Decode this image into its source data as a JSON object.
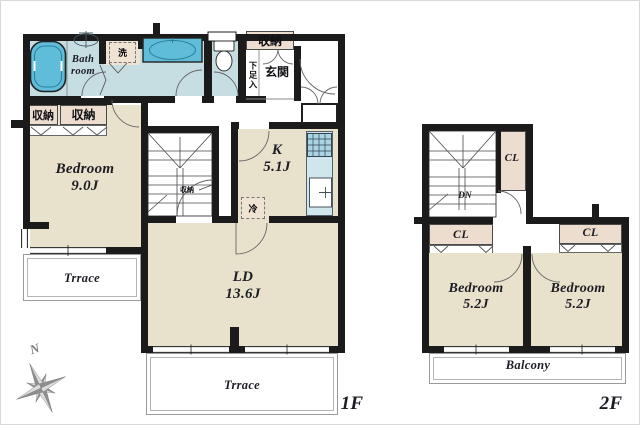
{
  "palette": {
    "wall": "#1b1b1b",
    "floor_beige": "#e8e1cb",
    "closet_beige": "#ecddce",
    "wet_blue": "#c6dde1",
    "fixture_blue": "#5fbdd9",
    "counter_blue": "#cfe7ec",
    "terrace_line": "#9a9a9a",
    "compass_gray": "#8e8e8e"
  },
  "icons": [
    "bathtub-icon",
    "washbasin-icon",
    "vanity-icon",
    "toilet-icon",
    "stove-icon",
    "kitchen-sink-icon",
    "refrigerator-space",
    "laundry-space",
    "staircase",
    "door-arc",
    "compass-rose-icon"
  ],
  "floor1": {
    "label": "1F",
    "bathroom_label": "Bath room",
    "laundry_label": "洗",
    "closet_left": "収納",
    "closet_right": "収納",
    "entry_storage": "収納",
    "shoe_cabinet": "下足入",
    "entrance": "玄関",
    "stair_storage": "収納",
    "bedroom": {
      "name": "Bedroom",
      "area": "9.0J"
    },
    "kitchen": {
      "name": "K",
      "area": "5.1J"
    },
    "fridge": "冷",
    "living": {
      "name": "LD",
      "area": "13.6J"
    },
    "terrace_side": "Trrace",
    "terrace_main": "Trrace"
  },
  "floor2": {
    "label": "2F",
    "closet_upper": "CL",
    "closet_left": "CL",
    "closet_right": "CL",
    "stairs_down": "DN",
    "bedroom_left": {
      "name": "Bedroom",
      "area": "5.2J"
    },
    "bedroom_right": {
      "name": "Bedroom",
      "area": "5.2J"
    },
    "balcony": "Balcony"
  },
  "compass": {
    "north": "N"
  }
}
